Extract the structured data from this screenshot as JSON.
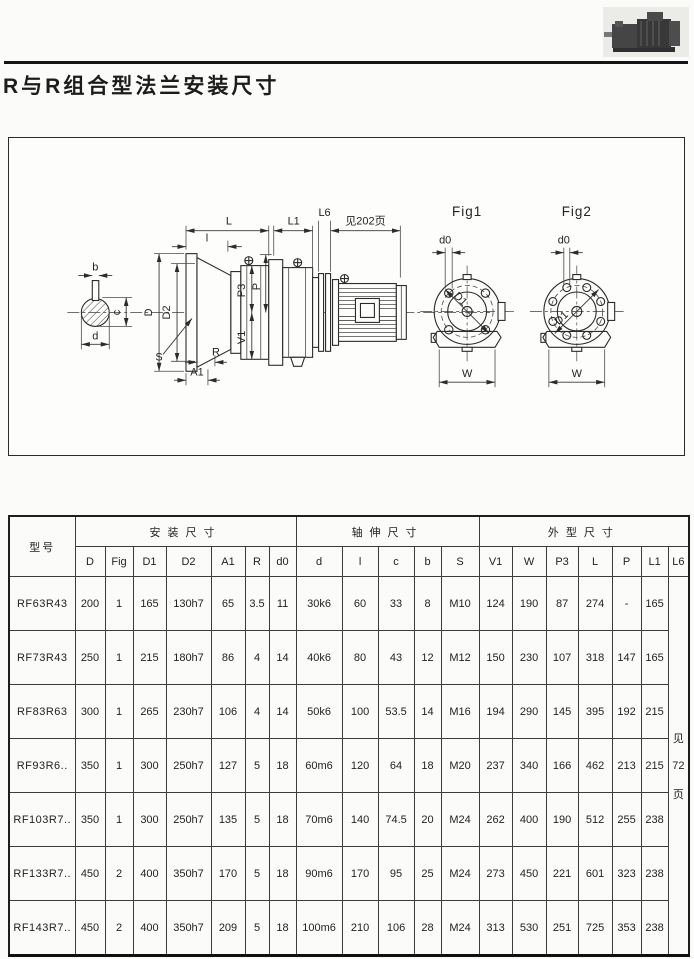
{
  "page": {
    "title": "R与R组合型法兰安装尺寸"
  },
  "drawing": {
    "labels": {
      "L": "L",
      "L1": "L1",
      "L6": "L6",
      "see_page": "见202页",
      "l": "l",
      "D": "D",
      "D2": "D2",
      "P3": "P3",
      "P": "P",
      "V1": "V1",
      "S": "S",
      "R": "R",
      "A1": "A1",
      "b": "b",
      "c": "c",
      "d": "d",
      "d0": "d0",
      "D1": "D1",
      "W": "W",
      "fig1": "Fig1",
      "fig2": "Fig2"
    }
  },
  "table": {
    "model_header": "型号",
    "groups": [
      {
        "label": "安装尺寸",
        "cols": [
          "D",
          "Fig",
          "D1",
          "D2",
          "A1",
          "R",
          "d0"
        ]
      },
      {
        "label": "轴伸尺寸",
        "cols": [
          "d",
          "l",
          "c",
          "b",
          "S"
        ]
      },
      {
        "label": "外型尺寸",
        "cols": [
          "V1",
          "W",
          "P3",
          "L",
          "P",
          "L1",
          "L6"
        ]
      }
    ],
    "rows": [
      [
        "RF63R43",
        "200",
        "1",
        "165",
        "130h7",
        "65",
        "3.5",
        "11",
        "30k6",
        "60",
        "33",
        "8",
        "M10",
        "124",
        "190",
        "87",
        "274",
        "-",
        "165"
      ],
      [
        "RF73R43",
        "250",
        "1",
        "215",
        "180h7",
        "86",
        "4",
        "14",
        "40k6",
        "80",
        "43",
        "12",
        "M12",
        "150",
        "230",
        "107",
        "318",
        "147",
        "165"
      ],
      [
        "RF83R63",
        "300",
        "1",
        "265",
        "230h7",
        "106",
        "4",
        "14",
        "50k6",
        "100",
        "53.5",
        "14",
        "M16",
        "194",
        "290",
        "145",
        "395",
        "192",
        "215"
      ],
      [
        "RF93R6..",
        "350",
        "1",
        "300",
        "250h7",
        "127",
        "5",
        "18",
        "60m6",
        "120",
        "64",
        "18",
        "M20",
        "237",
        "340",
        "166",
        "462",
        "213",
        "215"
      ],
      [
        "RF103R7..",
        "350",
        "1",
        "300",
        "250h7",
        "135",
        "5",
        "18",
        "70m6",
        "140",
        "74.5",
        "20",
        "M24",
        "262",
        "400",
        "190",
        "512",
        "255",
        "238"
      ],
      [
        "RF133R7..",
        "450",
        "2",
        "400",
        "350h7",
        "170",
        "5",
        "18",
        "90m6",
        "170",
        "95",
        "25",
        "M24",
        "273",
        "450",
        "221",
        "601",
        "323",
        "238"
      ],
      [
        "RF143R7..",
        "450",
        "2",
        "400",
        "350h7",
        "209",
        "5",
        "18",
        "100m6",
        "210",
        "106",
        "28",
        "M24",
        "313",
        "530",
        "251",
        "725",
        "353",
        "238"
      ]
    ],
    "l6_note": [
      "见",
      "72",
      "页"
    ]
  }
}
